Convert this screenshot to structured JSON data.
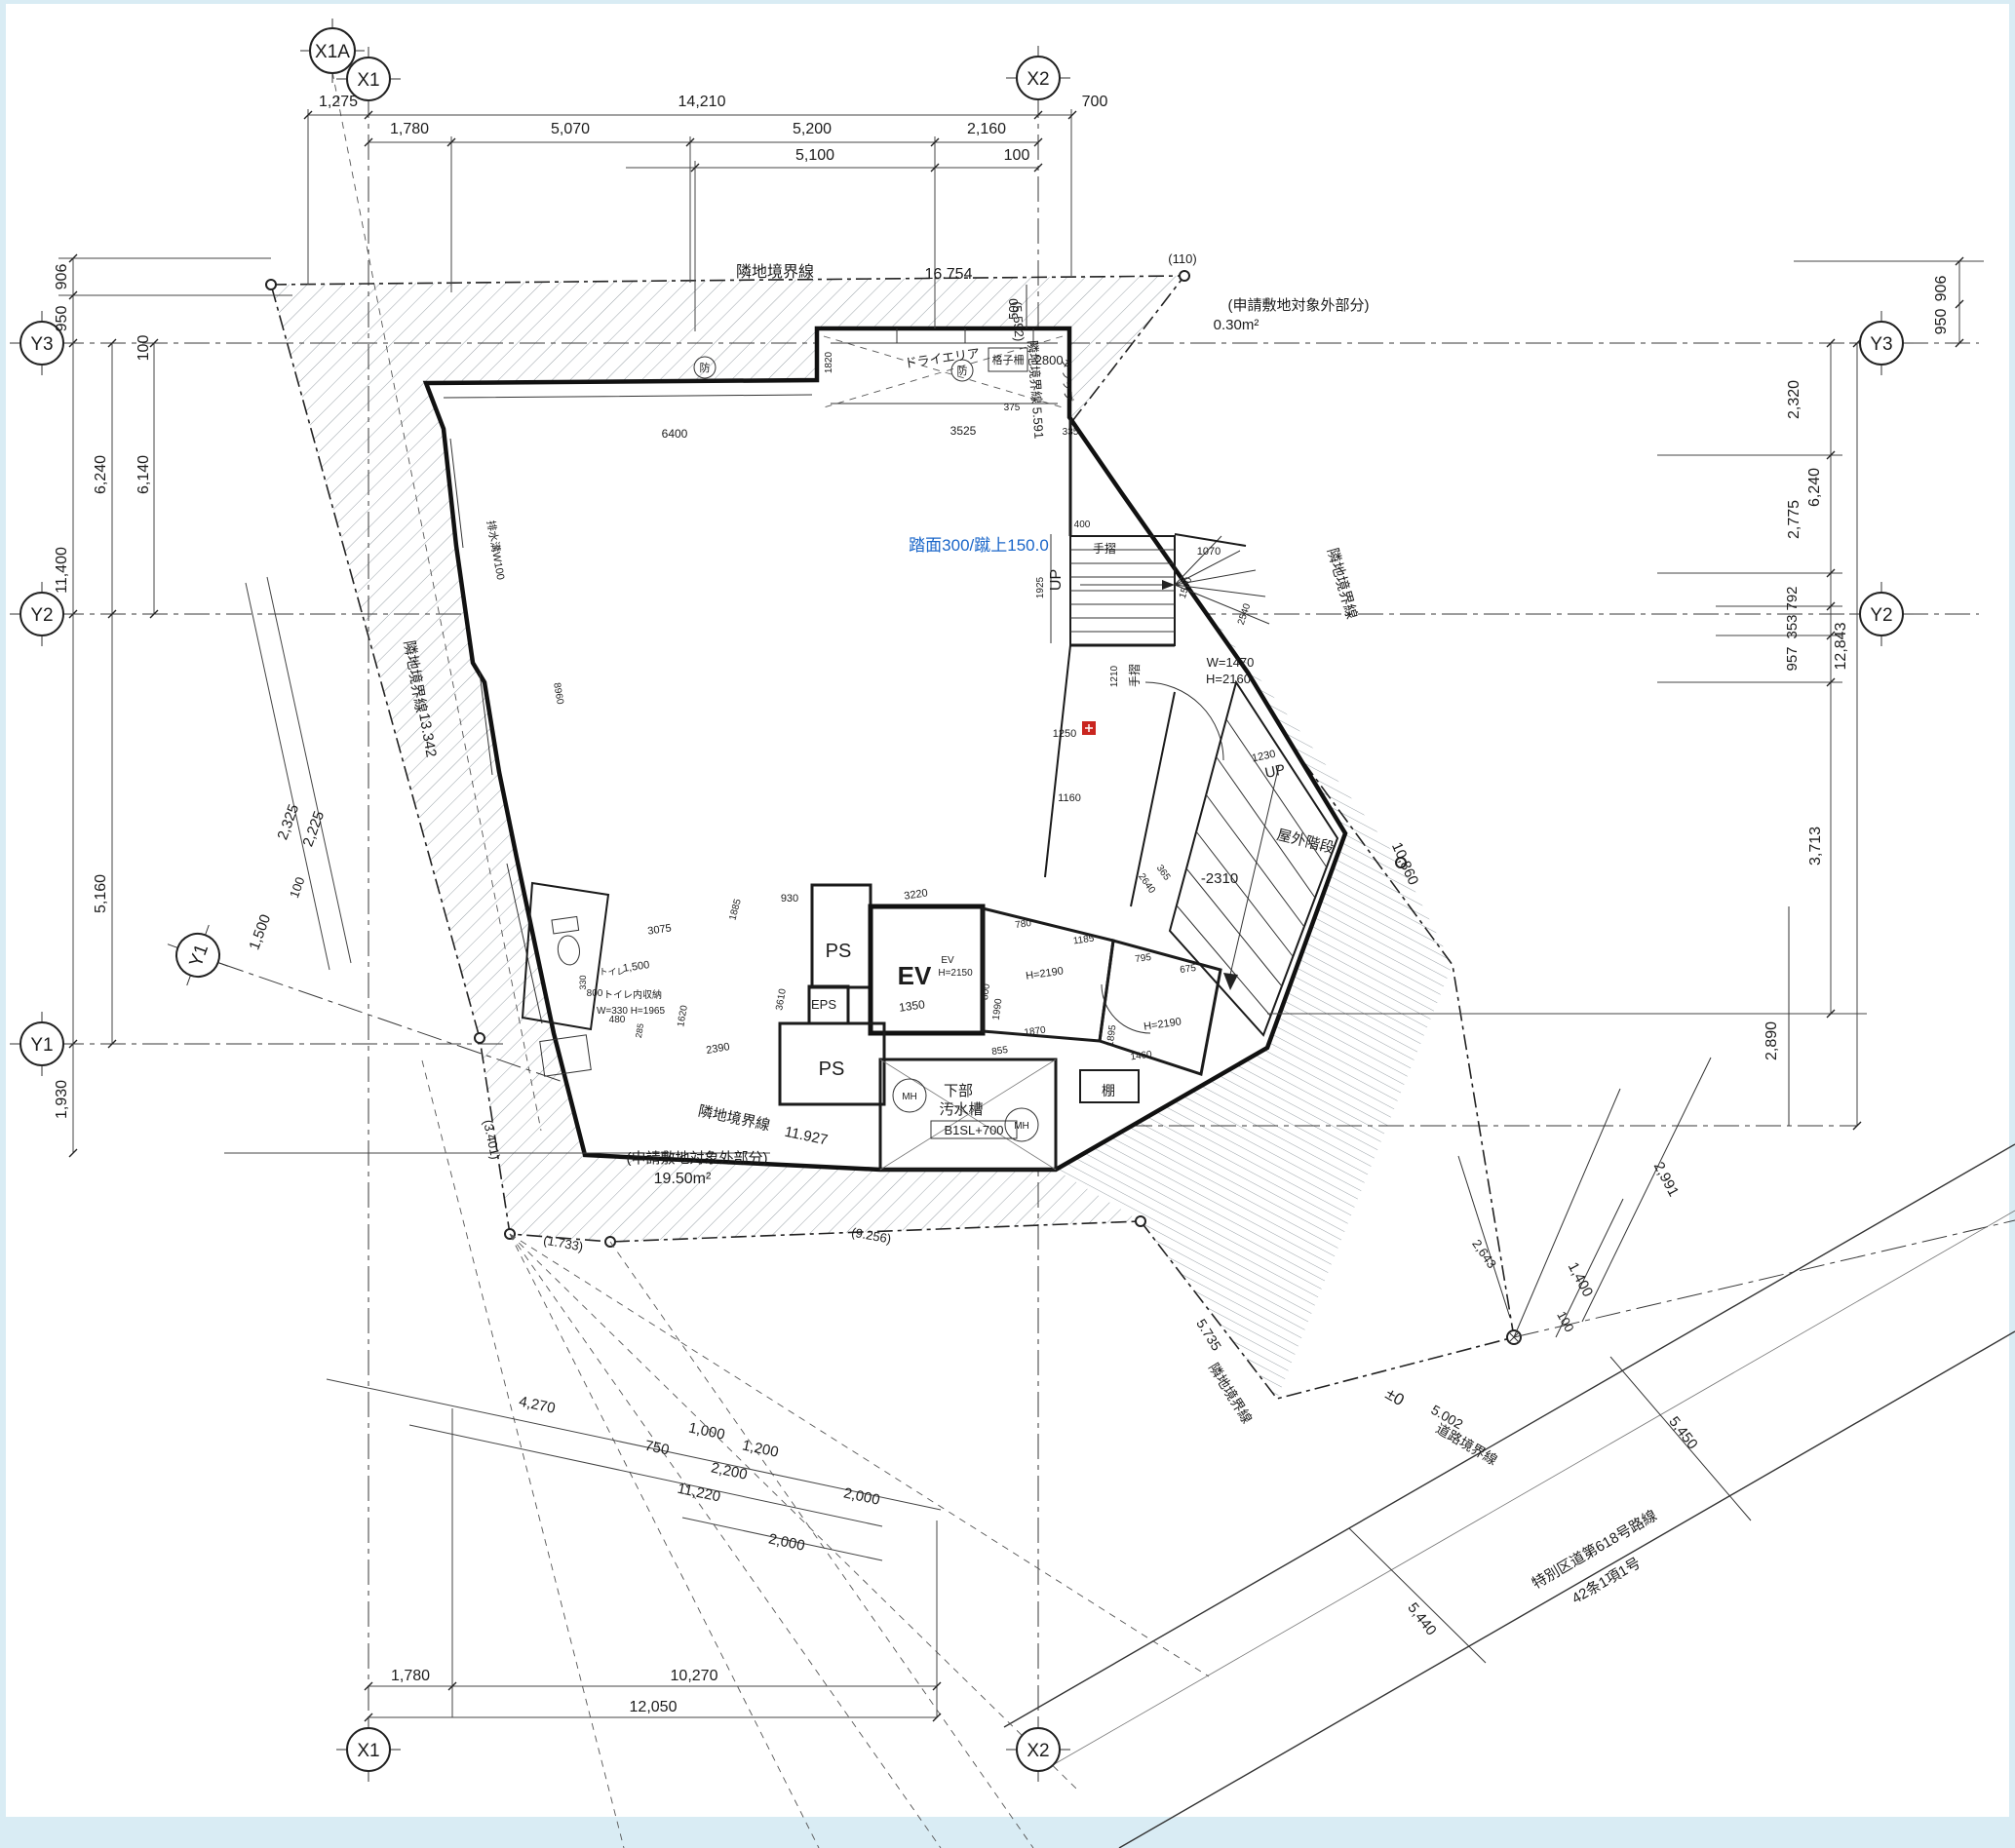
{
  "drawing": {
    "axis": {
      "x1a": "X1A",
      "x1": "X1",
      "x2": "X2",
      "y1": "Y1",
      "y2": "Y2",
      "y3": "Y3"
    },
    "boundary": {
      "neighbor": "隣地境界線",
      "road_line": "道路境界線",
      "len_top": "16.754",
      "len_left": "13.342",
      "len_bottom": "11.927",
      "len_right": "10,860",
      "len_5735": "5.735",
      "len_5591_full": "隣地境界線 5.591",
      "len_5592": "(5.592)",
      "len_110": "(110)",
      "len_3401": "(3.401)",
      "len_1733": "(1.733)",
      "len_9256": "(9.256)",
      "len_road": "5.002",
      "pm0": "±0"
    },
    "areas": {
      "excl_title": "(申請敷地対象外部分)",
      "excl_top": "0.30m²",
      "excl_bottom": "19.50m²"
    },
    "road": {
      "name1": "特別区道第618号路線",
      "name2": "42条1項1号"
    },
    "rooms": {
      "ev": "EV",
      "ev_small": "EV",
      "ev_h": "H=2150",
      "ps": "PS",
      "eps": "EPS",
      "shelf": "棚",
      "mh": "MH",
      "tank1": "下部",
      "tank2": "汚水槽",
      "tank_level": "B1SL+700",
      "outdoor_stair": "屋外階段",
      "dry_area": "ドライエリア",
      "lattice": "格子柵",
      "lattice_level": "-2800",
      "ladder": "タラップ",
      "up": "UP",
      "handrail": "手摺",
      "toilet": "トイレ",
      "toilet_storage1": "トイレ内収納",
      "toilet_storage2": "W=330 H=1965",
      "fire": "防",
      "stair_note": "踏面300/蹴上150.0",
      "drain": "排水溝W100",
      "level_2310": "-2310",
      "door_w": "W=1470",
      "door_h": "H=2160",
      "room_h": "H=2190"
    },
    "dims": {
      "d1275": "1,275",
      "d14210": "14,210",
      "d700": "700",
      "d1780": "1,780",
      "d5070": "5,070",
      "d5200": "5,200",
      "d2160": "2,160",
      "d5100": "5,100",
      "d100": "100",
      "d906": "906",
      "d950": "950",
      "d6240": "6,240",
      "d6140": "6,140",
      "d11400": "11,400",
      "d5160": "5,160",
      "d1930": "1,930",
      "d2325": "2,325",
      "d2225": "2,225",
      "d1500": "1,500",
      "d2320": "2,320",
      "d2775": "2,775",
      "d792": "792",
      "d353": "353",
      "d957": "957",
      "d12843": "12,843",
      "d3713": "3,713",
      "d2890": "2,890",
      "d2991": "2,991",
      "d2643": "2,643",
      "d1400": "1,400",
      "d5450": "5,450",
      "d5440": "5,440",
      "d4270": "4,270",
      "d750": "750",
      "d1000": "1,000",
      "d1200": "1,200",
      "d2200": "2,200",
      "d11220": "11,220",
      "d2000": "2,000",
      "d10270": "10,270",
      "d12050": "12,050",
      "d500": "500",
      "d6400": "6400",
      "d3525": "3525",
      "d375": "375",
      "d335": "335",
      "d1820": "1820",
      "d1925": "1925",
      "d400": "400",
      "d1070": "1070",
      "d1540": "1540",
      "d2540": "2540",
      "d1210": "1210",
      "d1250": "1250",
      "d1160": "1160",
      "d1230": "1230",
      "d3220": "3220",
      "d780": "780",
      "d1185": "1185",
      "d795": "795",
      "d675": "675",
      "d800": "800",
      "d1990": "1990",
      "d1870": "1870",
      "d855": "855",
      "d1895": "1895",
      "d1460": "1460",
      "d2640": "2640",
      "d365": "365",
      "d1350": "1350",
      "d930": "930",
      "d3075": "3075",
      "d1885": "1885",
      "d1620": "1620",
      "d3610": "3610",
      "d480": "480",
      "d285": "285",
      "d330": "330",
      "d8960": "8960",
      "d2390": "2390"
    }
  }
}
